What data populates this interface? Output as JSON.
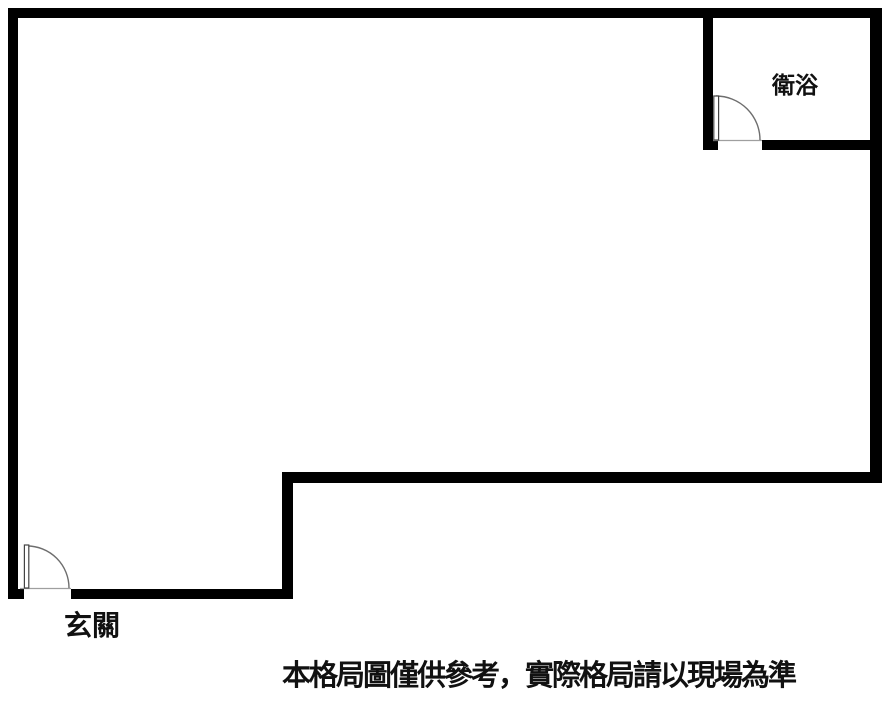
{
  "floor_plan": {
    "labels": {
      "bathroom": "衛浴",
      "entrance": "玄關",
      "disclaimer": "本格局圖僅供參考，實際格局請以現場為準"
    },
    "colors": {
      "wall": "#000000",
      "text": "#111111",
      "door_line": "#6e6e6e",
      "door_leaf": "#444444",
      "door_sill": "#9f9f9f",
      "background": "#ffffff"
    }
  }
}
